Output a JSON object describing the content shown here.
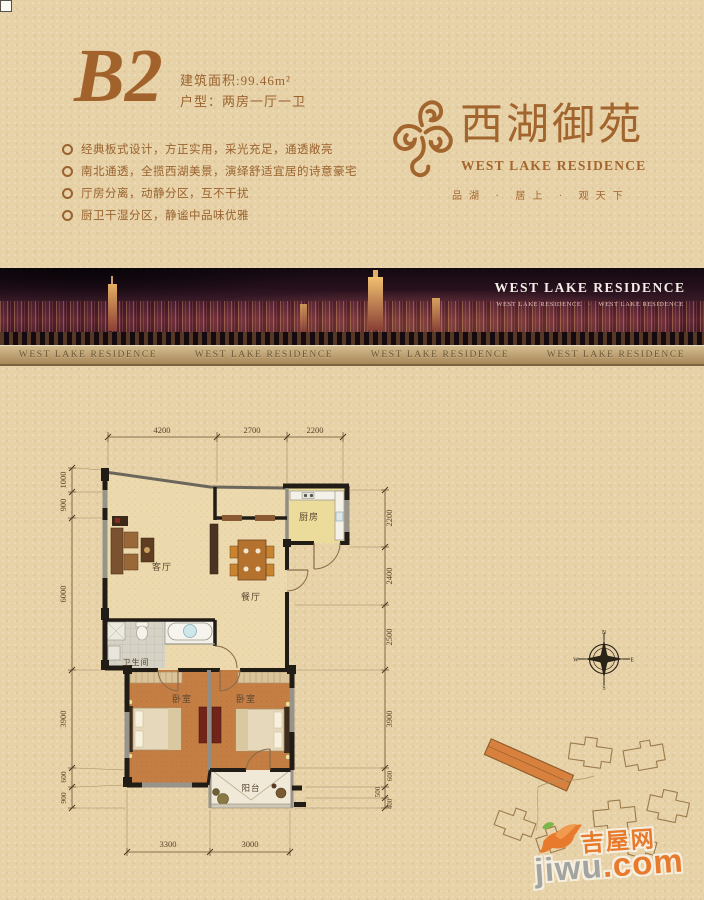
{
  "header": {
    "unit_code": "B2",
    "area_label": "建筑面积:99.46m²",
    "type_label": "户型：两房一厅一卫",
    "features": [
      "经典板式设计，方正实用，采光充足，通透敞亮",
      "南北通透，全揽西湖美景，演绎舒适宜居的诗意豪宅",
      "厅房分离，动静分区，互不干扰",
      "厨卫干湿分区，静谧中品味优雅"
    ]
  },
  "brand": {
    "name_cn": "西湖御苑",
    "name_en": "WEST LAKE RESIDENCE",
    "tagline": "品湖 · 居上 · 观天下"
  },
  "banner": {
    "overlay_title": "WEST LAKE RESIDENCE",
    "overlay_subtitle": "WEST LAKE RESIDENCE　·　WEST LAKE RESIDENCE",
    "strip_labels": [
      "WEST LAKE RESIDENCE",
      "WEST LAKE RESIDENCE",
      "WEST LAKE RESIDENCE",
      "WEST LAKE RESIDENCE"
    ]
  },
  "floorplan": {
    "rooms": {
      "living": "客厅",
      "dining": "餐厅",
      "kitchen": "厨房",
      "bath": "卫生间",
      "bedroom1": "卧室",
      "bedroom2": "卧室",
      "balcony": "阳台"
    },
    "dims_top": [
      "4200",
      "2700",
      "2200"
    ],
    "dims_bottom": [
      "3300",
      "3000"
    ],
    "dims_left": [
      "1000",
      "900",
      "6000",
      "3900",
      "600",
      "900"
    ],
    "dims_right": [
      "2200",
      "2400",
      "2500",
      "3900",
      "600",
      "500",
      "400"
    ],
    "compass": [
      "N",
      "E",
      "S",
      "W"
    ]
  },
  "watermark": {
    "site_cn": "吉屋网",
    "site_en_name": "jiwu",
    "site_en_tld": ".com"
  },
  "colors": {
    "accent_brown": "#a2652e",
    "background": "#e7d1a6",
    "bedroom_floor": "#c47e43",
    "kitchen_floor": "#ecdc9c",
    "watermark_orange": "#e87a2e"
  }
}
